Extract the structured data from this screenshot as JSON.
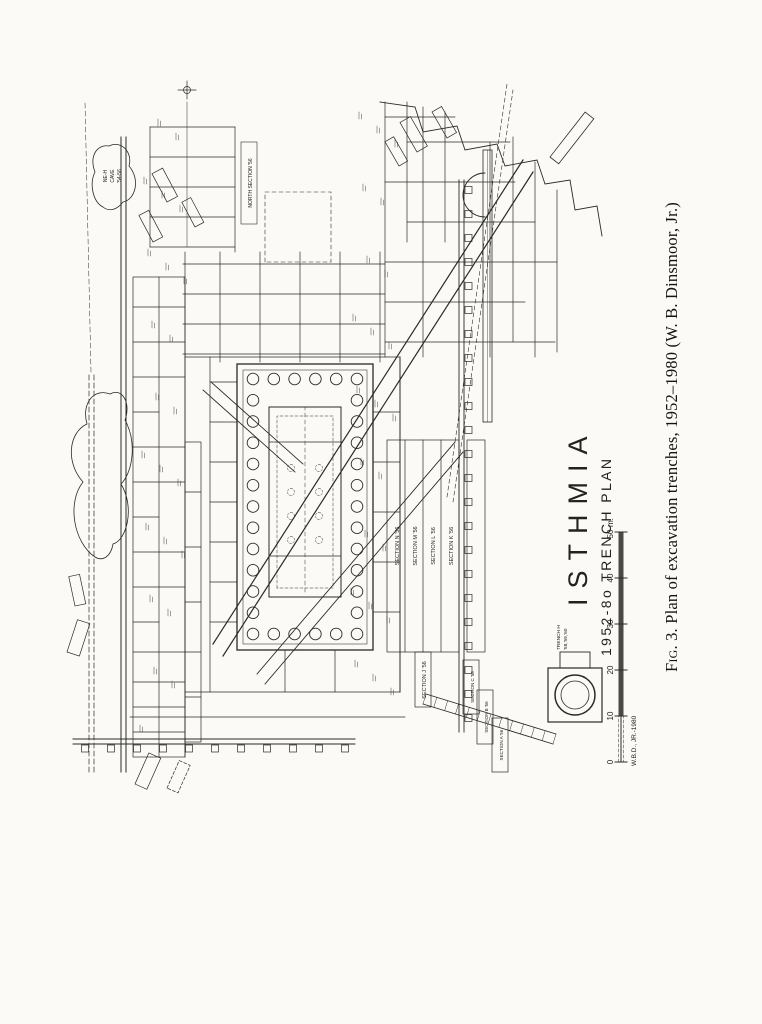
{
  "figure": {
    "caption_label": "Fig. 3.",
    "caption_text": " Plan of excavation trenches, 1952–1980 (W. B. Dinsmoor, Jr.)"
  },
  "plan": {
    "title": "ISTHMIA",
    "subtitle": "1952-8o TRENCH PLAN",
    "credit": "W.B.D., JR.-1980",
    "scale": {
      "ticks": [
        "0",
        "10",
        "20",
        "30",
        "40",
        "50"
      ],
      "unit": "m."
    },
    "labels": {
      "trench_h_line1": "TRENCH H",
      "trench_h_line2": "'58,'59,'60",
      "north_section": "NORTH SECTION '56",
      "ne_cave_line1": "NE-H",
      "ne_cave_line2": "CAVE",
      "ne_cave_line3": "'54-56",
      "sections_south": [
        "SECTION N '56",
        "SECTION M '56",
        "SECTION L '56",
        "SECTION K '56",
        "SECTION J '56"
      ],
      "sections_east": [
        "SECTION C '56",
        "SECTION B '56",
        "SECTION A '56"
      ]
    },
    "colors": {
      "ink": "#2a2a27",
      "paper": "#fbfaf6"
    }
  }
}
